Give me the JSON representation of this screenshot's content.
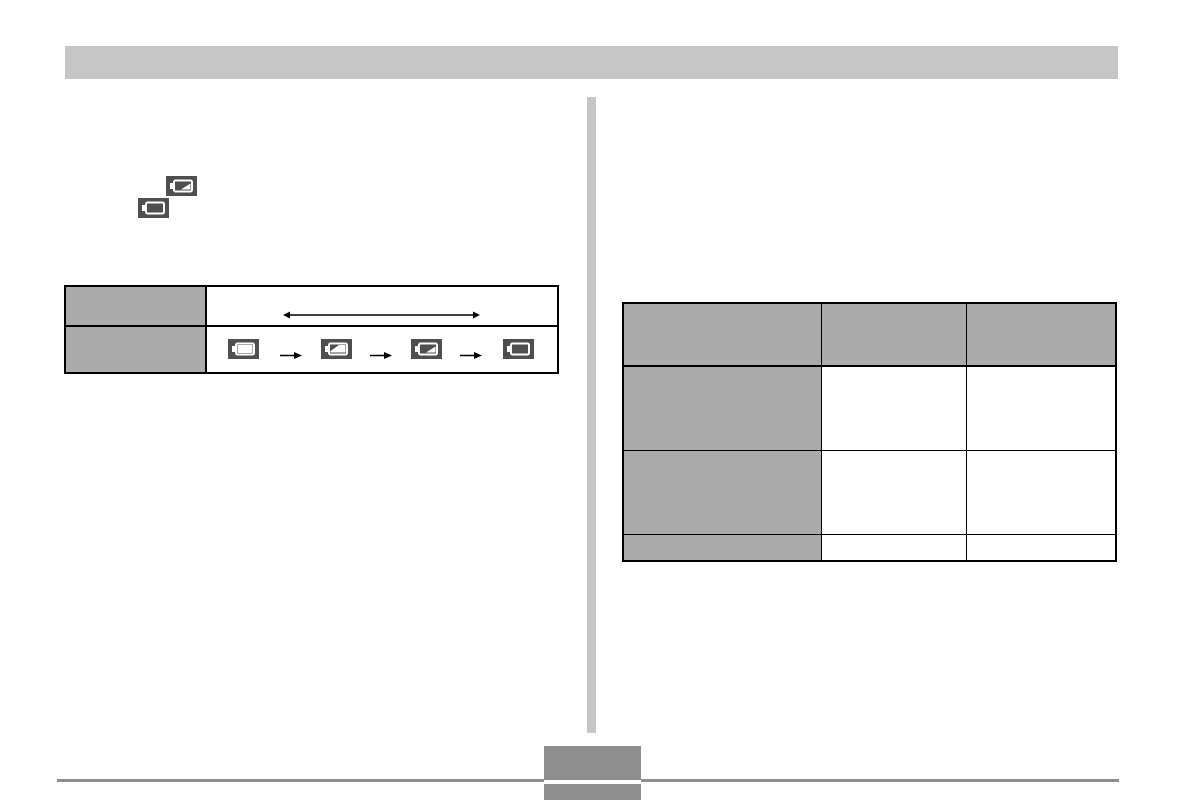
{
  "page": {
    "width": 1183,
    "height": 800,
    "kind": "scanned manual page"
  },
  "colors": {
    "background": "#ffffff",
    "header_bar": "#c6c6c6",
    "divider": "#c6c6c6",
    "table_header": "#ababab",
    "table_border": "#000000",
    "icon_tile": "#4f4f4f",
    "icon_glyph": "#ffffff",
    "footer": "#8e8e8e",
    "arrow": "#000000"
  },
  "header": {
    "bar_text": ""
  },
  "left_column": {
    "standalone_icons": [
      {
        "icon": "battery-one-third-icon",
        "level": "one-third"
      },
      {
        "icon": "battery-empty-icon",
        "level": "empty"
      }
    ],
    "battery_table": {
      "rows": [
        {
          "header": "",
          "content_type": "double-arrow"
        },
        {
          "header": "",
          "content_type": "battery-sequence"
        }
      ],
      "double_arrow_symbol": "↔",
      "arrow_symbol": "→",
      "battery_sequence": [
        {
          "icon": "battery-full-icon",
          "level": "full"
        },
        {
          "icon": "battery-two-thirds-icon",
          "level": "two-thirds"
        },
        {
          "icon": "battery-one-third-icon",
          "level": "one-third"
        },
        {
          "icon": "battery-empty-icon",
          "level": "empty"
        }
      ]
    }
  },
  "right_column": {
    "data_table": {
      "columns": 3,
      "header_row": [
        "",
        "",
        ""
      ],
      "rows": [
        [
          "",
          "",
          ""
        ],
        [
          "",
          "",
          ""
        ],
        [
          "",
          "",
          ""
        ]
      ]
    }
  },
  "footer": {
    "section_label": "",
    "page_number": ""
  }
}
